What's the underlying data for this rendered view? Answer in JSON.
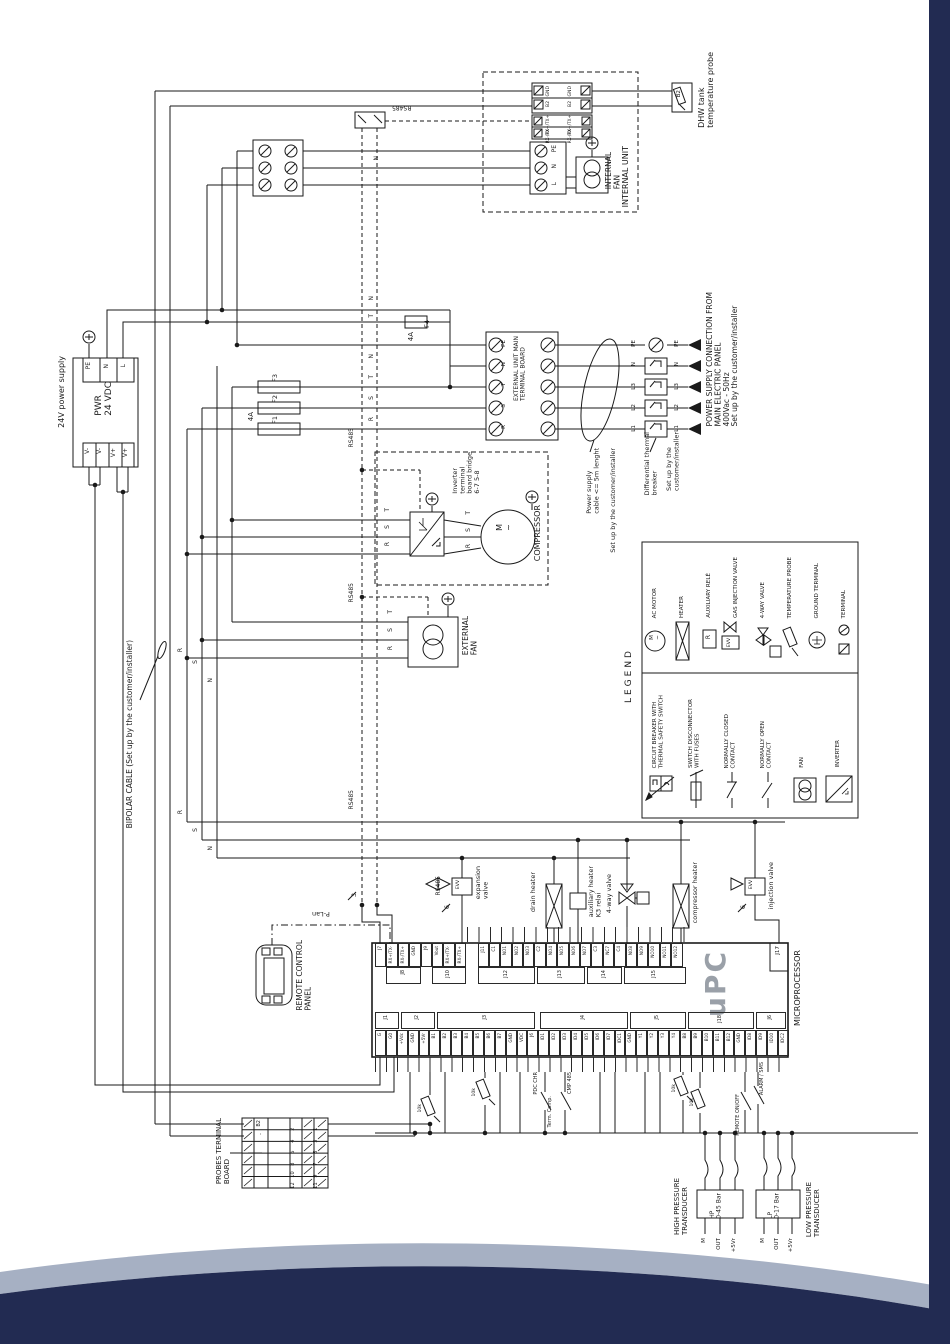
{
  "top": {
    "dhw_probe_label": "DHW tank\ntemperature probe",
    "dhw_ref": "B2",
    "internal_unit": "INTERNAL UNIT",
    "internal_fan": "INTERNAL\nFAN",
    "blockA_c1r1": "GND",
    "blockA_c1r2": "B2",
    "blockA_c2r1": "GND",
    "blockA_c2r2": "B2",
    "blockB_c1r1": "RX+/TX+",
    "blockB_c1r2": "RX-/TX-",
    "blockB_c2r1": "RX+/TX+",
    "blockB_c2r2": "RX-/TX-",
    "pnl_pe": "PE",
    "pnl_n": "N",
    "pnl_l": "L",
    "rs485_top": "RS485"
  },
  "psu": {
    "label": "24V power supply",
    "title": "PWR\n24 VDC",
    "top_terms": [
      "PE",
      "N",
      "L"
    ],
    "bottom_terms": [
      "V-",
      "V-",
      "V+",
      "V+"
    ]
  },
  "fuses": {
    "f1": "F1",
    "f2": "F2",
    "f3": "F3",
    "f4": "F4",
    "a123": "4A",
    "a4": "4A"
  },
  "ext_board": {
    "title": "EXTERNAL UNIT MAIN\nTERMINAL BOARD",
    "rows": [
      "PE",
      "N",
      "T",
      "S",
      "R"
    ]
  },
  "cable_note": {
    "l1": "Power supply\ncable <= 5m lenght",
    "l2": "Set up by the customer/installer"
  },
  "breaker": {
    "rows": [
      "PE",
      "N",
      "L3",
      "L2",
      "L1"
    ],
    "label": "Differential thermal\nbreaker",
    "sub": "Set up by the\ncustomer/installer"
  },
  "power_conn": "POWER SUPPLY CONNECTION FROM\nMAIN ELECTRIC PANEL\n400Vac - 50Hz\nSet up by the customer/installer",
  "compressor": {
    "title": "COMPRESSOR",
    "motor": "M\n~",
    "inverter_note": "Inverter\nterminal\nboard bridge\n6-7 5-8"
  },
  "external_fan": {
    "label": "EXTERNAL\nFAN"
  },
  "rs485": {
    "a": "RS485",
    "b": "RS485",
    "c": "RS485",
    "d": "RS485",
    "tick3": "3",
    "tick6a": "6",
    "tick6b": "6"
  },
  "bipolar": "BIPOLAR CABLE (Set up by the customer/installer)",
  "remote": {
    "label": "REMOTE CONTROL\nPANEL",
    "plan": "P-Lan"
  },
  "legend": {
    "title": "LEGEND",
    "g1": [
      "AC MOTOR",
      "HEATER",
      "AUXILIARY RELÈ",
      "GAS INJECTION VALVE",
      "4-WAY VALVE",
      "TEMPERATURE PROBE",
      "GROUND TERMINAL",
      "TERMINAL"
    ],
    "g2": [
      "CIRCUIT BREAKER WITH\nTHERMAL SAFETY SWITCH",
      "SWITCH DISCONNECTOR\nWITH FUSES",
      "NORMALLY CLOSED\nCONTACT",
      "NORMALLY OPEN\nCONTACT",
      "FAN",
      "INVERTER"
    ],
    "sym_m": "M\n~",
    "sym_r": "R",
    "sym_evv": "EVV"
  },
  "micro": {
    "name": "MICROPROCESSOR",
    "upc": "uPC",
    "j17": "J17",
    "top_pins": [
      "J7",
      "RX+/TX-",
      "RX-/TX+",
      "GND",
      "J9",
      "Vout",
      "RX+/TX-",
      "RX-/TX+",
      "",
      "J11",
      "C1",
      "NO1",
      "NO2",
      "NO3",
      "C2",
      "NO4",
      "NO5",
      "NO6",
      "NO7",
      "C3",
      "NC7",
      "C4",
      "NO8",
      "NO9",
      "NO10",
      "NO11",
      "NO12"
    ],
    "top_brackets": [
      "J8",
      "J10",
      "J12",
      "J13",
      "J14",
      "J15"
    ],
    "bottom_pins": [
      "G",
      "G0",
      "+Vdc",
      "GND",
      "+5Vr",
      "B1",
      "B2",
      "B3",
      "B4",
      "B5",
      "B6",
      "B7",
      "GND",
      "VDC",
      "J6",
      "ID1",
      "ID2",
      "ID3",
      "ID4",
      "ID5",
      "ID6",
      "ID7",
      "IDC1",
      "GND",
      "Y1",
      "Y2",
      "Y3",
      "Y4",
      "B8",
      "B9",
      "B10",
      "B11",
      "B12",
      "GND",
      "ID8",
      "ID9",
      "ID10",
      "IDC2"
    ],
    "bottom_brackets": [
      "J1",
      "J2",
      "J3",
      "J4",
      "J5",
      "J18",
      "J6"
    ]
  },
  "loads": {
    "expansion": "expansion\nvalve",
    "evv1": "EVV",
    "drain": "drain heater",
    "aux": "auxiliary heater\nK3 relai",
    "fourway": "4-way valve",
    "comp_heater": "compressor heater",
    "injection": "injection valve",
    "evv2": "EVV"
  },
  "bottom": {
    "c1": "PDC CHR",
    "c2": "Term. Comp.",
    "c3": "CMP 485",
    "c4": "REMOTE ON/OFF",
    "c5": "ALARM / SMS",
    "t1": "10k",
    "t2": "10k",
    "t3": "10k",
    "t4": "10k"
  },
  "probes_board": {
    "title": "PROBES TERMINAL\nBOARD",
    "left1": "B2",
    "left2": "-",
    "inner": [
      "2",
      "4",
      "6",
      "8",
      "10",
      "12"
    ],
    "outer": [
      "1",
      "3",
      "5",
      "7",
      "9",
      "11"
    ]
  },
  "transducers": {
    "hp_label": "HIGH PRESSURE\nTRANSDUCER",
    "hp_text": "HP\n0-45 Bar",
    "hp_pins": [
      "M",
      "OUT",
      "+5Vr"
    ],
    "lp_label": "LOW PRESSURE\nTRANSDUCER",
    "lp_text": "LP\n0-17 Bar",
    "lp_pins": [
      "M",
      "OUT",
      "+5Vr"
    ]
  },
  "wire_labels": [
    "N",
    "T",
    "N",
    "T",
    "S",
    "R",
    "T",
    "S",
    "R",
    "T",
    "S",
    "R",
    "T",
    "S",
    "R",
    "R",
    "S",
    "N",
    "R",
    "S",
    "N",
    "N"
  ]
}
